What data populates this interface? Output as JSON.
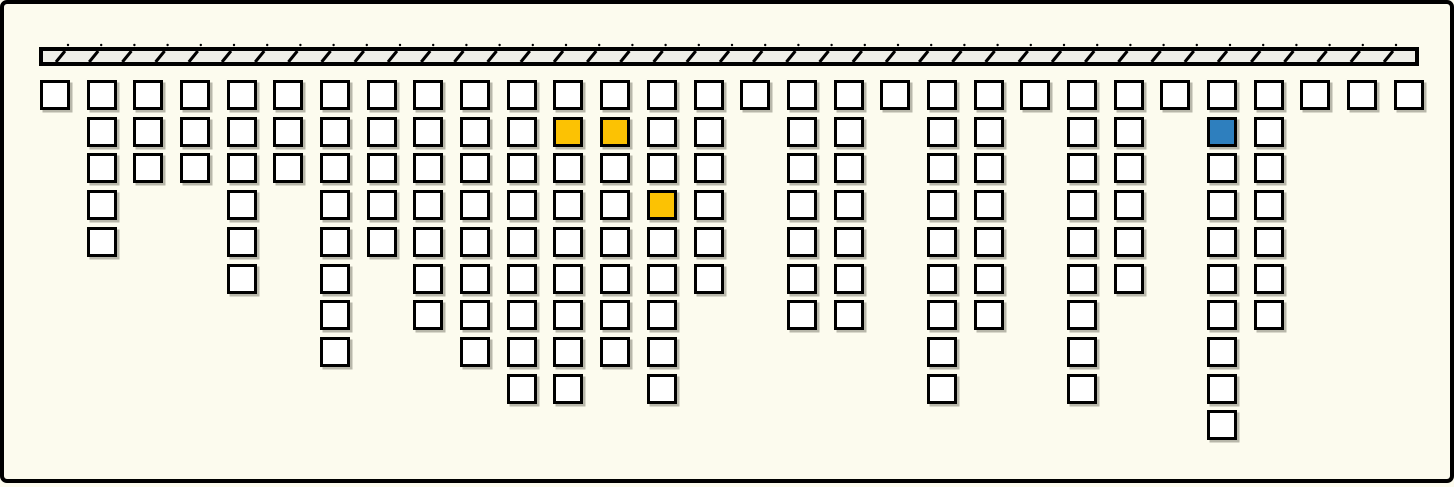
{
  "figure": {
    "background_color": "#FCFBEE",
    "frame_border_color": "#000000"
  },
  "hatched_bar": {
    "x": 35,
    "y": 43,
    "width": 1380,
    "height": 19,
    "fill_color": "#EFEFE8",
    "stroke_color": "#000000",
    "hatch_count": 41,
    "hatch_pitch": 33.2,
    "hatch_direction": "forward-slash"
  },
  "grid": {
    "origin_x": 36,
    "origin_y": 76,
    "col_pitch": 46.68,
    "row_pitch": 36.7,
    "square_size": 30,
    "square_fill": "#FFFFFF",
    "square_border": "#000000",
    "num_columns": 30,
    "max_rows": 10,
    "column_counts": [
      1,
      5,
      3,
      3,
      6,
      3,
      8,
      5,
      7,
      8,
      9,
      9,
      8,
      9,
      6,
      1,
      7,
      7,
      1,
      9,
      7,
      1,
      9,
      6,
      1,
      10,
      7,
      1,
      1,
      1
    ],
    "highlight_colors": {
      "yellow": "#FCC203",
      "blue": "#2E7FBE"
    },
    "highlighted_cells": [
      {
        "col": 11,
        "row": 2,
        "color": "yellow"
      },
      {
        "col": 12,
        "row": 2,
        "color": "yellow"
      },
      {
        "col": 13,
        "row": 4,
        "color": "yellow"
      },
      {
        "col": 25,
        "row": 2,
        "color": "blue"
      }
    ]
  }
}
